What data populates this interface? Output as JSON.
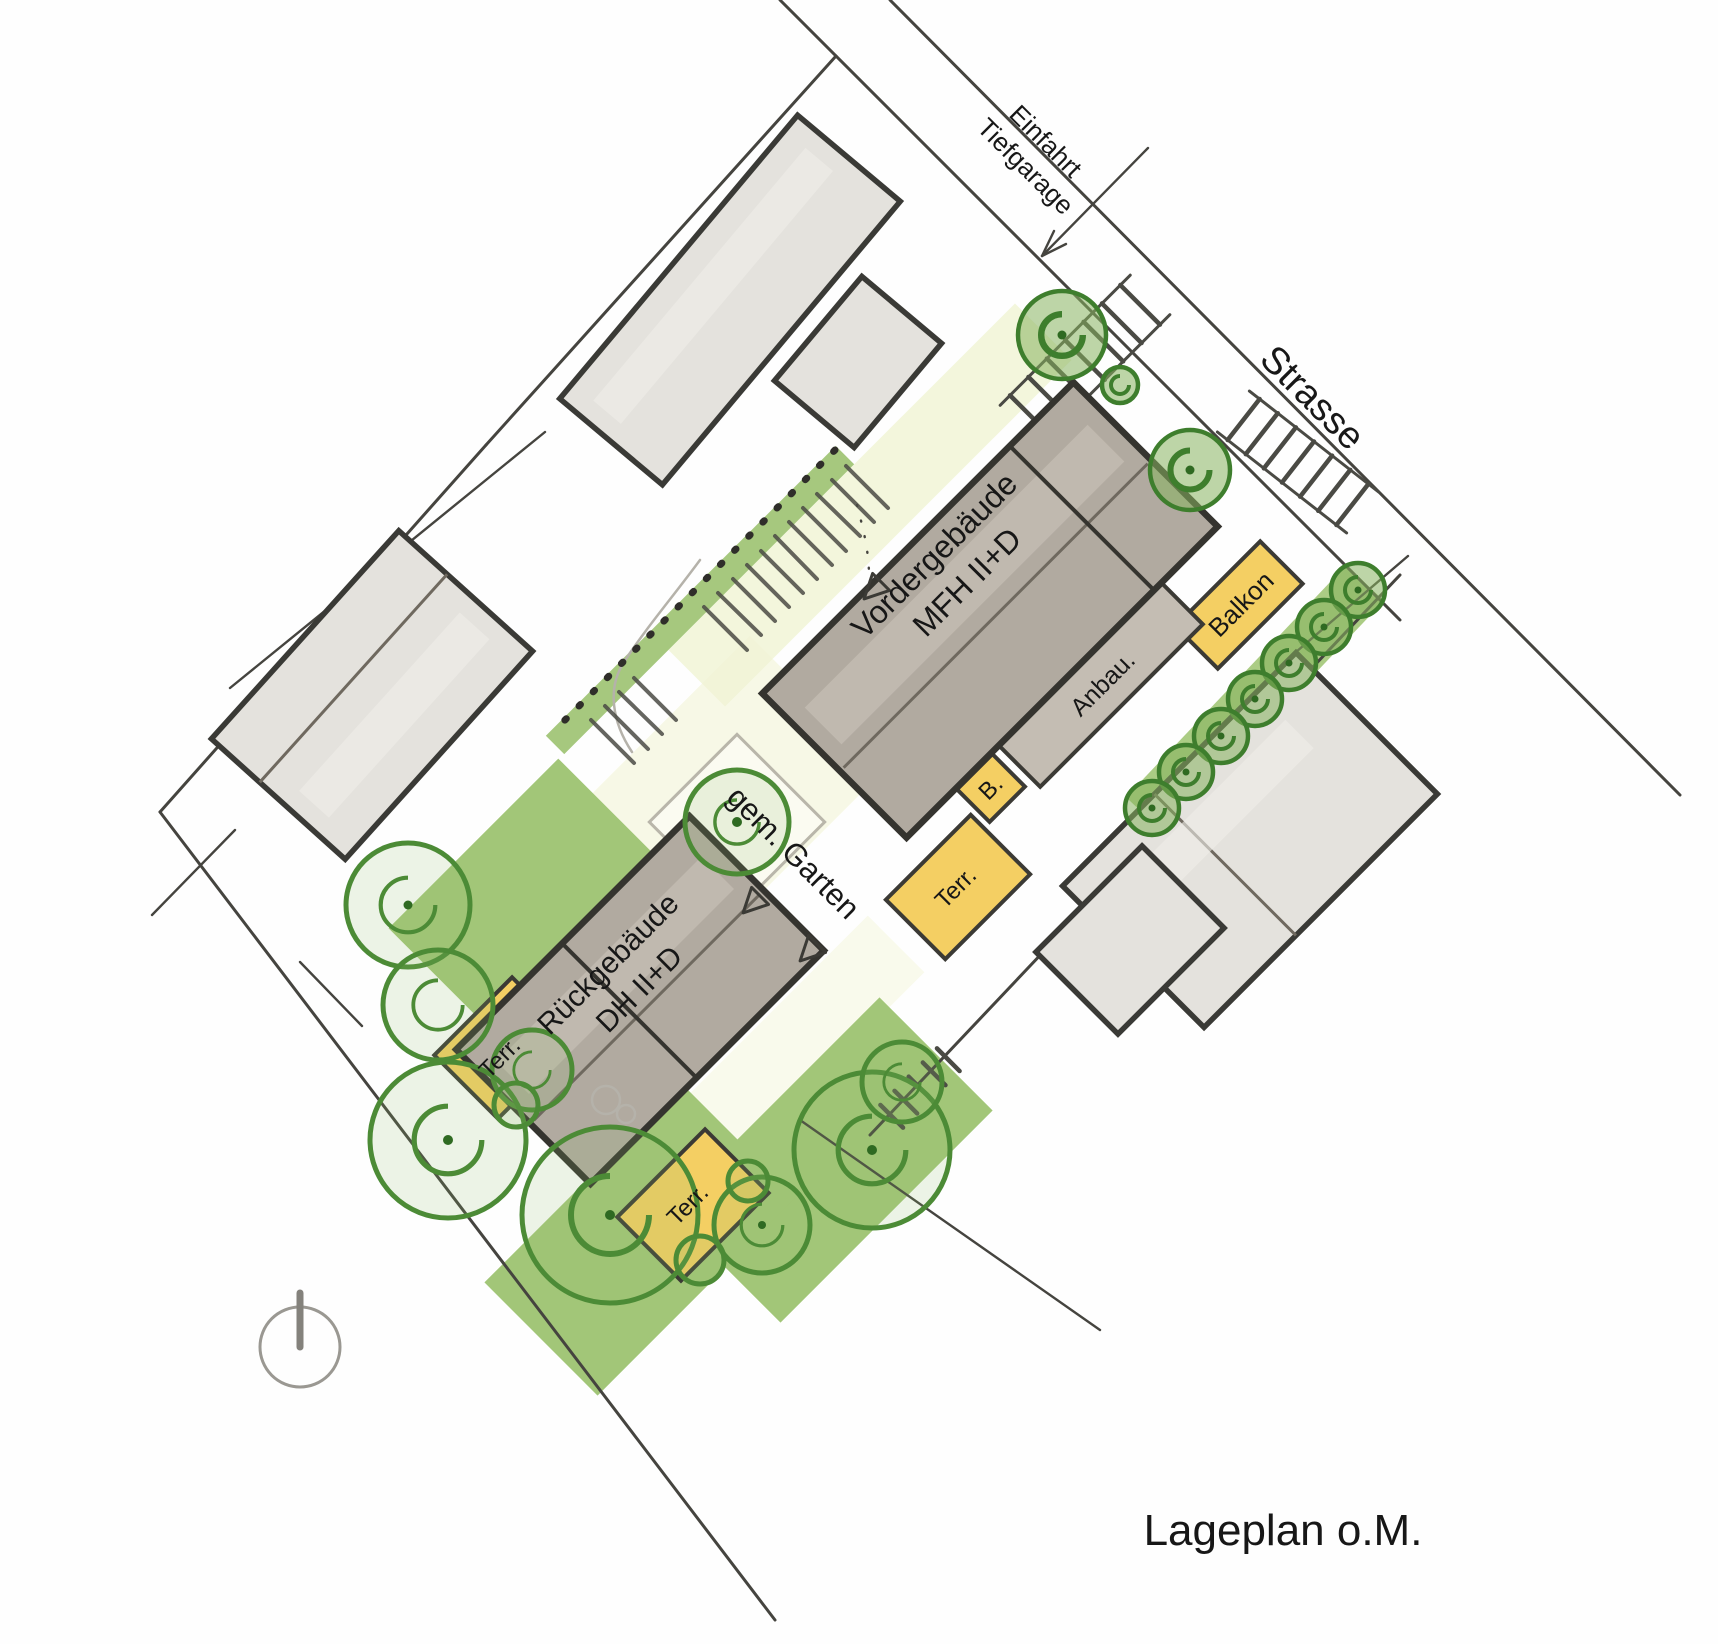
{
  "title": "Lageplan o.M.",
  "annotations": {
    "entrance_line1": "Einfahrt",
    "entrance_line2": "Tiefgarage",
    "street": "Strasse",
    "garden": "gem. Garten"
  },
  "buildings": {
    "front": {
      "name": "Vordergebäude",
      "type": "MFH II+D"
    },
    "rear": {
      "name": "Rückgebäude",
      "type": "DH II+D"
    }
  },
  "features": {
    "balcony_large": "Balkon",
    "annex": "Anbau.",
    "balcony_small": "B.",
    "terrace_front": "Terr.",
    "terrace_rear_west": "Terr.",
    "terrace_rear_south": "Terr."
  },
  "colors": {
    "paper": "#fefefe",
    "project_building_fill": "#b1aaa0",
    "neighbor_building_fill": "#e4e2dd",
    "annex_fill": "#c4bdb3",
    "terrace_yellow": "#f4cf63",
    "lawn_green": "#a2c678",
    "tree_green": "#4c8b36",
    "path_tint": "#f1f4d6",
    "ink": "#3b3a35"
  }
}
